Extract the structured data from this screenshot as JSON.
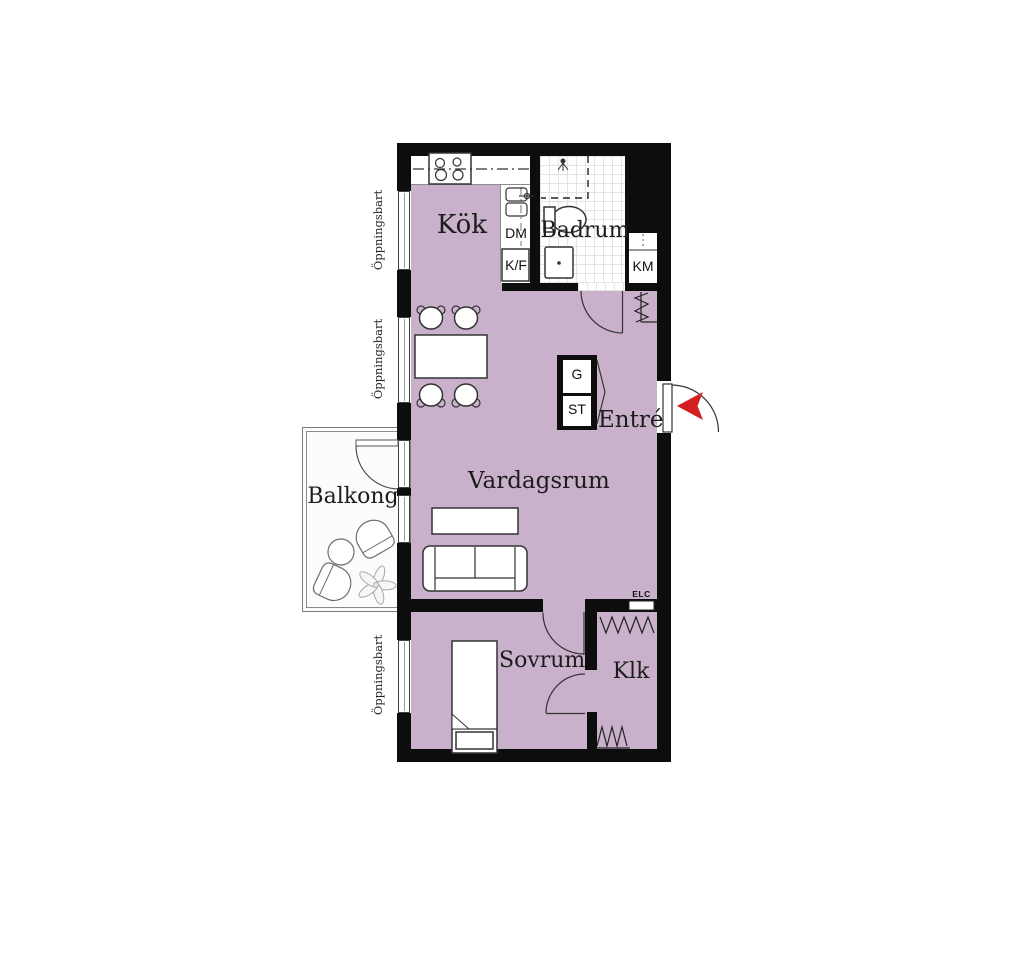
{
  "plan": {
    "rooms": {
      "kitchen": "Kök",
      "bathroom": "Badrum",
      "entrance": "Entré",
      "living_room": "Vardagsrum",
      "balcony": "Balkong",
      "bedroom": "Sovrum",
      "closet": "Klk"
    },
    "labels": {
      "dishwasher": "DM",
      "fridge_freezer": "K/F",
      "washing_machine": "KM",
      "wardrobe_g": "G",
      "cleaning_st": "ST",
      "electrical": "ELC",
      "openable_window": "Öppningsbart"
    },
    "colors": {
      "floor": "#c9b1cc",
      "wall": "#0d0d0d",
      "entry_arrow": "#d31f1f"
    }
  }
}
